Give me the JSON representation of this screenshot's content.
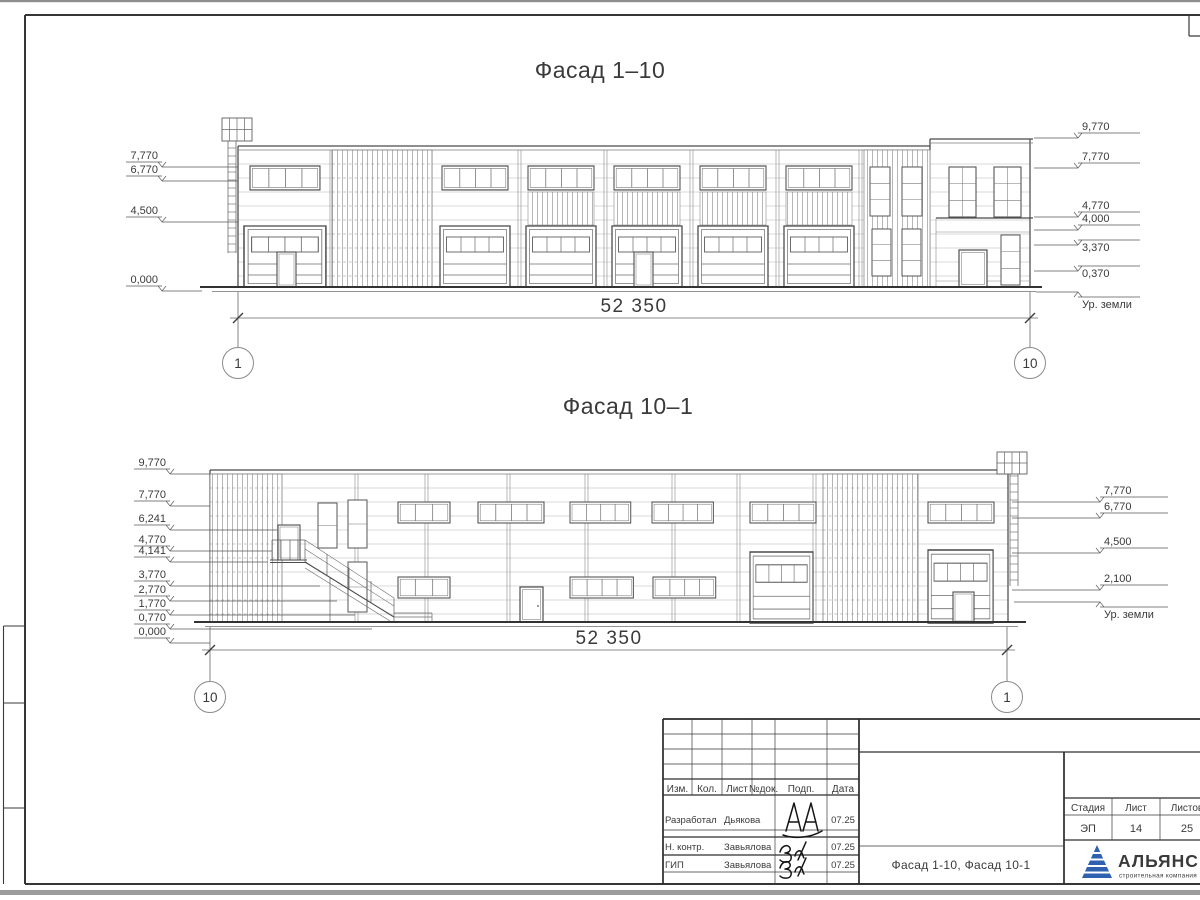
{
  "facade1": {
    "title": "Фасад 1–10",
    "dimension": "52 350",
    "axis_left": "1",
    "axis_right": "10",
    "left_marks": [
      "7,770",
      "6,770",
      "4,500",
      "0,000"
    ],
    "right_marks": [
      "9,770",
      "7,770",
      "4,770",
      "4,000",
      "3,370",
      "0,370"
    ],
    "ground_label": "Ур. земли"
  },
  "facade2": {
    "title": "Фасад 10–1",
    "dimension": "52 350",
    "axis_left": "10",
    "axis_right": "1",
    "left_marks": [
      "9,770",
      "7,770",
      "6,241",
      "4,770",
      "4,141",
      "3,770",
      "2,770",
      "1,770",
      "0,770",
      "0,000"
    ],
    "right_marks": [
      "7,770",
      "6,770",
      "4,500",
      "2,100"
    ],
    "ground_label": "Ур. земли"
  },
  "title_block": {
    "columns": [
      "Изм.",
      "Кол.",
      "Лист",
      "№док.",
      "Подп.",
      "Дата"
    ],
    "rows": [
      {
        "role": "Разработал",
        "name": "Дьякова",
        "date": "07.25"
      },
      {
        "role": "Н. контр.",
        "name": "Завьялова",
        "date": "07.25"
      },
      {
        "role": "ГИП",
        "name": "Завьялова",
        "date": "07.25"
      }
    ],
    "doc_title": "Фасад 1-10, Фасад 10-1",
    "stage_label": "Стадия",
    "stage": "ЭП",
    "sheet_label": "Лист",
    "sheet": "14",
    "sheets_label": "Листов",
    "sheets": "25",
    "logo": {
      "name": "АЛЬЯНС",
      "tagline": "строительная компания",
      "name_color": "#20339b",
      "tagline_color": "#3f7ac2",
      "triangle_color": "#2e62b0"
    }
  }
}
